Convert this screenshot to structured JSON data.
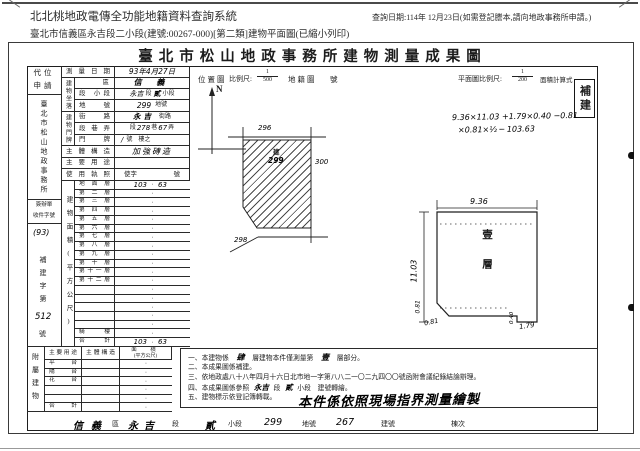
{
  "header": {
    "system_title": "北北桃地政電傳全功能地籍資料查詢系統",
    "query_date": "查詢日期:114年 12月23日(如需登記謄本,請向地政事務所申請。)",
    "doc_info": "臺北市信義區永吉段二小段(建號:00267-000)[第二類]建物平面圖(已縮小列印)"
  },
  "title": "臺北市松山地政事務所建物測量成果圖",
  "stamp": "補建",
  "apply_col": {
    "surrogate_l1": "代位",
    "surrogate_l2": "申請",
    "office": "臺北市松山地政事務所",
    "docket_l1": "簽辦單",
    "docket_l2": "收件字號",
    "docket_no": "(93)",
    "rebuild_label": "補建字第",
    "rebuild_no": "512",
    "rebuild_suffix": "號"
  },
  "info": {
    "survey_date_label": "測量日期",
    "survey_date": "93年4月27日",
    "site_group": "建物坐落",
    "district_label": "區",
    "district": "信 義",
    "section_label": "段 小段",
    "section_hand1": "永吉",
    "section_print1": "段",
    "section_hand2": "貳",
    "section_print2": "小段",
    "lot_label": "地號",
    "lot_no": "299",
    "lot_suffix": "地號",
    "addr_group": "建物門牌",
    "street_label": "街路",
    "street_hand": "永吉",
    "street_suffix": "街路",
    "lane_label": "段巷弄",
    "lane_print1": "段",
    "lane_hand1": "278",
    "lane_print2": "巷",
    "lane_hand2": "67",
    "lane_print3": "弄",
    "door_label": "門牌",
    "door_hand": "∕",
    "door_value": "號　樓之",
    "structure_label": "主體構造",
    "structure": "加強磚造",
    "use_label": "主要用途",
    "license_label": "使用執照",
    "license_l": "使字",
    "license_r": "號"
  },
  "area": {
    "group_label": "建物面積(平方公尺)",
    "dot": "·",
    "floors": [
      {
        "label": "地面層",
        "l": "103",
        "r": "63"
      },
      {
        "label": "第二層"
      },
      {
        "label": "第三層"
      },
      {
        "label": "第四層"
      },
      {
        "label": "第五層"
      },
      {
        "label": "第六層"
      },
      {
        "label": "第七層"
      },
      {
        "label": "第八層"
      },
      {
        "label": "第九層"
      },
      {
        "label": "第十層"
      },
      {
        "label": "第十一層"
      },
      {
        "label": "第十二層"
      },
      {
        "label": ""
      },
      {
        "label": ""
      },
      {
        "label": ""
      },
      {
        "label": ""
      },
      {
        "label": ""
      },
      {
        "label": "騎樓"
      },
      {
        "label": "合計",
        "l": "103",
        "r": "63"
      }
    ]
  },
  "attach": {
    "group_label": "附屬建物",
    "use_header": "主要用途",
    "structure_header": "主體構造",
    "area_header_l1": "面　積",
    "area_header_l2": "(平方公尺)",
    "rows": [
      {
        "use": "平台"
      },
      {
        "use": "陽台"
      },
      {
        "use": "花台"
      },
      {
        "use": ""
      },
      {
        "use": ""
      },
      {
        "use": "合計"
      }
    ]
  },
  "scales": {
    "location_label": "位置圖",
    "scale_label": "比例尺:",
    "loc_num": "1",
    "loc_den": "500",
    "cadastral_label": "地籍圖",
    "number_label": "號",
    "plan_scale_label": "平面圖比例尺:",
    "plan_num": "1",
    "plan_den": "200",
    "calc_label": "面積計算式"
  },
  "compass": {
    "n": "N"
  },
  "location_map": {
    "north_lot": "296",
    "east_lot": "300",
    "south_lot": "298",
    "subject_mark": "建",
    "subject_lot": "299"
  },
  "formula": {
    "line1": "9.36×11.03 +1.79×0.40 −0.81",
    "line2": "×0.81×½ ─ 103.63"
  },
  "plan": {
    "width_dim": "9.36",
    "height_dim": "11.03",
    "bevel_a": "0.81",
    "bevel_b": "0.81",
    "notch_h": "0.40",
    "notch_w": "1.79",
    "floor_text": "壹層"
  },
  "notes": {
    "n1_pre": "一、本建物係",
    "n1_hand1": "肆",
    "n1_mid": "層建物本件僅測量第",
    "n1_hand2": "壹",
    "n1_suf": "層部分。",
    "n2": "二、本成果圖係補建。",
    "n3": "三、依地政處八十八年四月十六日北市地一字第八八二一〇二九四〇〇號函附會議紀錄結論辦理。",
    "n4_pre": "四、本成果圖係參照",
    "n4_hand1": "永吉",
    "n4_mid": "段",
    "n4_hand2": "貳",
    "n4_suf": "小段　建號轉繪。",
    "n5": "五、建物標示依登記簿轉載。",
    "n5_hand": "本件係依照現場指界測量繪製"
  },
  "footer": {
    "district_hand": "信義",
    "district_suffix": "區",
    "section_hand": "永吉",
    "section_suffix": "段",
    "subsection_hand": "貳",
    "subsection_suffix": "小段",
    "lot_hand": "299",
    "lot_suffix": "地號",
    "building_hand": "267",
    "building_suffix": "建號",
    "unit_label": "棟次"
  }
}
